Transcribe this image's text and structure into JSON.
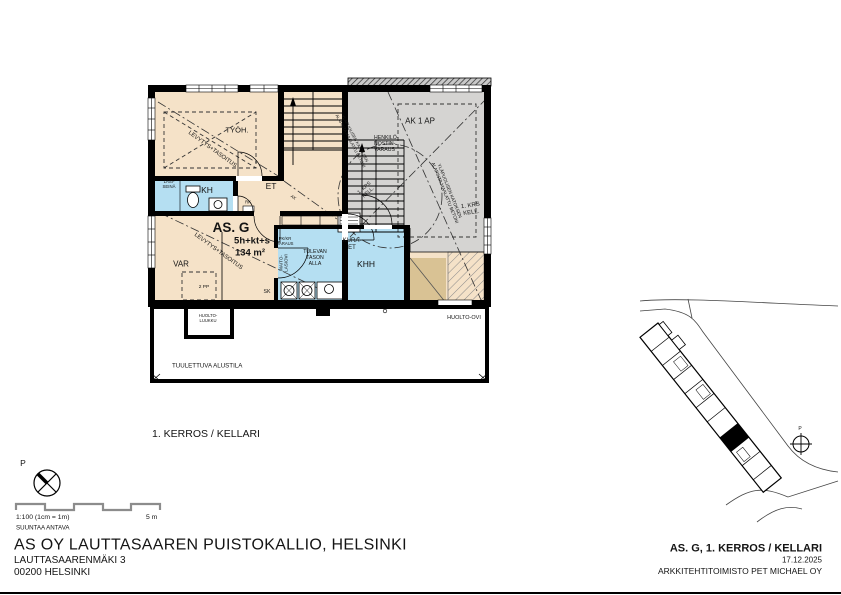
{
  "colors": {
    "room_beige": "#f5e2c8",
    "room_blue": "#b5dff2",
    "area_gray": "#d5d4d2",
    "ramp_brown": "#d9c294",
    "wall": "#000000"
  },
  "plan": {
    "labels": {
      "tyoh": "TYÖH.",
      "levytys": "LEVYTYS+TASOITUS",
      "lasi_seina": [
        "LASI-",
        "SEINÄ"
      ],
      "kh": "KH",
      "et": "ET",
      "rk": "RK",
      "ak_mark": "AK",
      "apartment": "AS. G",
      "rooms_spec": "5h+kt+s",
      "area": "134 m²",
      "var": "VAR",
      "pp": "2 PP",
      "sk": "SK",
      "maito_lasiovi": [
        "MAITO-",
        "LASIOVI"
      ],
      "pk_varaus": [
        "PK/KR",
        "VARAUS"
      ],
      "tulevan": [
        "TULEVAN",
        "TASON",
        "ALLA"
      ],
      "kura_et": [
        "KURA-",
        "ET"
      ],
      "khh": "KHH",
      "henkilonostin": [
        "HENKILÖ-",
        "NOSTIN-",
        "VARAUS"
      ],
      "ak_1_ap": "AK 1 AP",
      "krs_kell": [
        "1. KRS",
        "KELL."
      ],
      "ylapuolisen": [
        "YLÄPUOLISEN KATOKSEN",
        "ALAPINTA MAALATTU BETONI"
      ],
      "huolto_luukku": [
        "HUOLTO-",
        "LUUKKU"
      ],
      "huolto_ovi": "HUOLTO-OVI",
      "tuulettuva": "TUULETTUVA ALUSTILA",
      "floor_label": "1. KERROS / KELLARI"
    }
  },
  "legend": {
    "north": "P",
    "scale": "1:100 (1cm = 1m)",
    "scale_end": "5 m",
    "disclaimer": "SUUNTAA ANTAVA"
  },
  "sitemap": {
    "north": "P"
  },
  "title_block": {
    "project": "AS OY LAUTTASAAREN PUISTOKALLIO, HELSINKI",
    "address1": "LAUTTASAARENMÄKI 3",
    "address2": "00200 HELSINKI",
    "drawing": "AS. G, 1. KERROS / KELLARI",
    "date": "17.12.2025",
    "architect": "ARKKITEHTITOIMISTO PET MICHAEL OY"
  }
}
